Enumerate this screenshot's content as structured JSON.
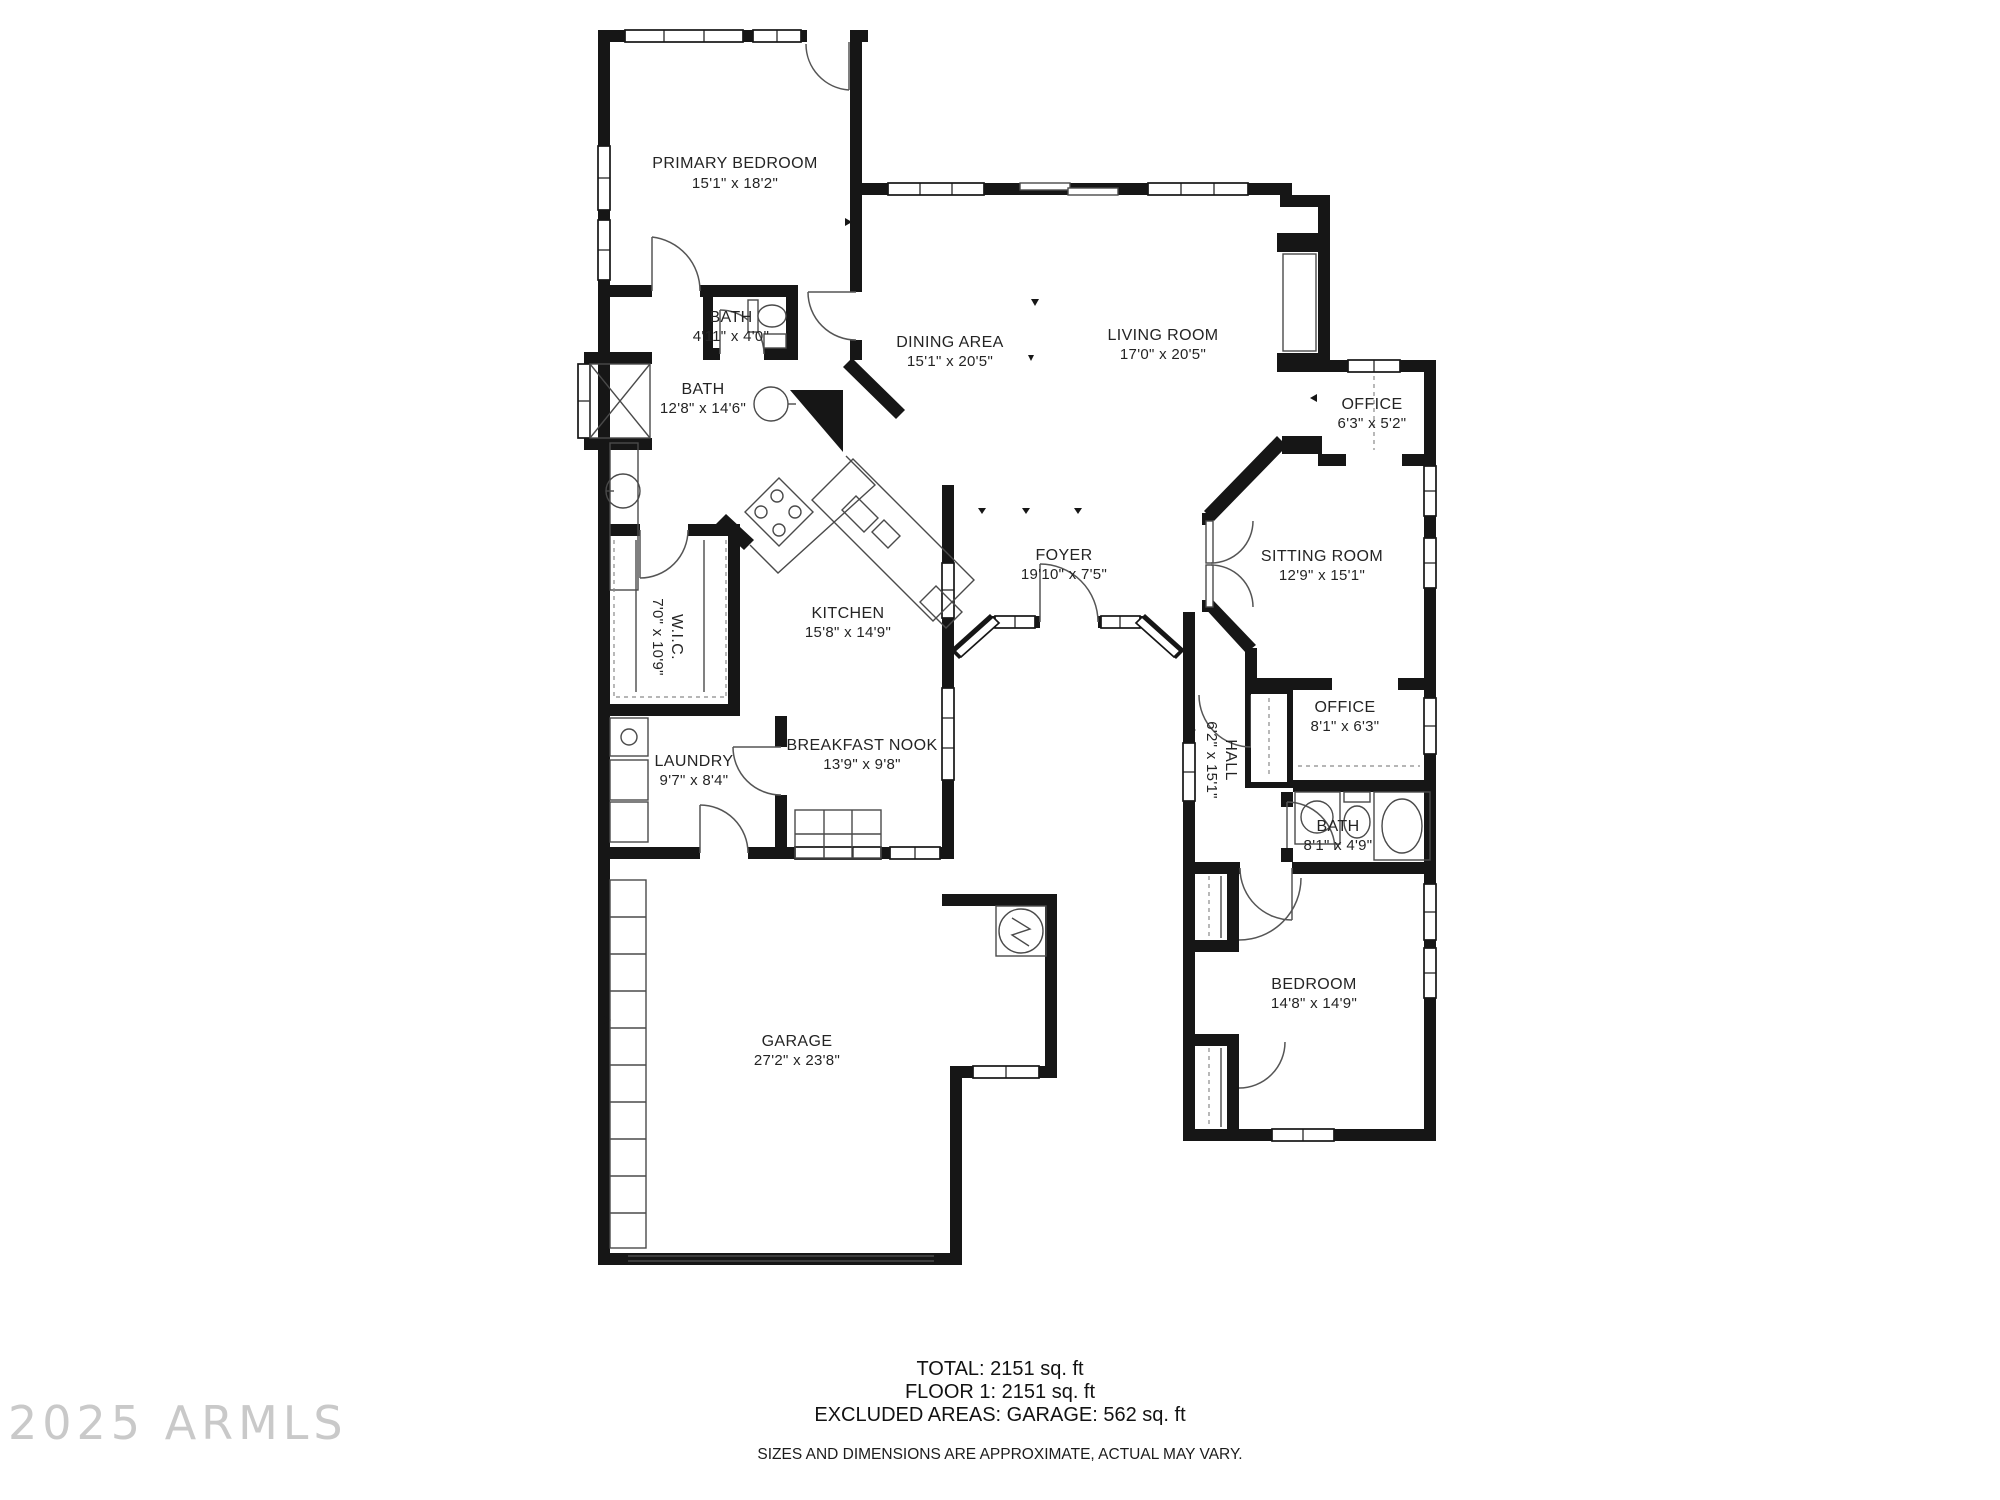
{
  "watermark": "2025 ARMLS",
  "rooms": {
    "primary_bedroom": {
      "name": "PRIMARY BEDROOM",
      "dims": "15'1\" x 18'2\""
    },
    "bath_small": {
      "name": "BATH",
      "dims": "4'11\" x 4'0\""
    },
    "bath_primary": {
      "name": "BATH",
      "dims": "12'8\" x 14'6\""
    },
    "dining_area": {
      "name": "DINING AREA",
      "dims": "15'1\" x 20'5\""
    },
    "living_room": {
      "name": "LIVING ROOM",
      "dims": "17'0\" x 20'5\""
    },
    "office_upper": {
      "name": "OFFICE",
      "dims": "6'3\" x 5'2\""
    },
    "sitting_room": {
      "name": "SITTING ROOM",
      "dims": "12'9\" x 15'1\""
    },
    "kitchen": {
      "name": "KITCHEN",
      "dims": "15'8\" x 14'9\""
    },
    "foyer": {
      "name": "FOYER",
      "dims": "19'10\" x 7'5\""
    },
    "wic": {
      "name": "W.I.C.",
      "dims": "7'0\" x 10'9\""
    },
    "laundry": {
      "name": "LAUNDRY",
      "dims": "9'7\" x 8'4\""
    },
    "breakfast_nook": {
      "name": "BREAKFAST NOOK",
      "dims": "13'9\" x 9'8\""
    },
    "hall": {
      "name": "HALL",
      "dims": "6'2\" x 15'1\""
    },
    "office_lower": {
      "name": "OFFICE",
      "dims": "8'1\" x 6'3\""
    },
    "bath_lower": {
      "name": "BATH",
      "dims": "8'1\" x 4'9\""
    },
    "garage": {
      "name": "GARAGE",
      "dims": "27'2\" x 23'8\""
    },
    "bedroom": {
      "name": "BEDROOM",
      "dims": "14'8\" x 14'9\""
    }
  },
  "footer": {
    "line1": "TOTAL: 2151 sq. ft",
    "line2": "FLOOR 1: 2151 sq. ft",
    "line3": "EXCLUDED AREAS: GARAGE: 562 sq. ft",
    "disclaimer": "SIZES AND DIMENSIONS ARE APPROXIMATE, ACTUAL MAY VARY."
  }
}
